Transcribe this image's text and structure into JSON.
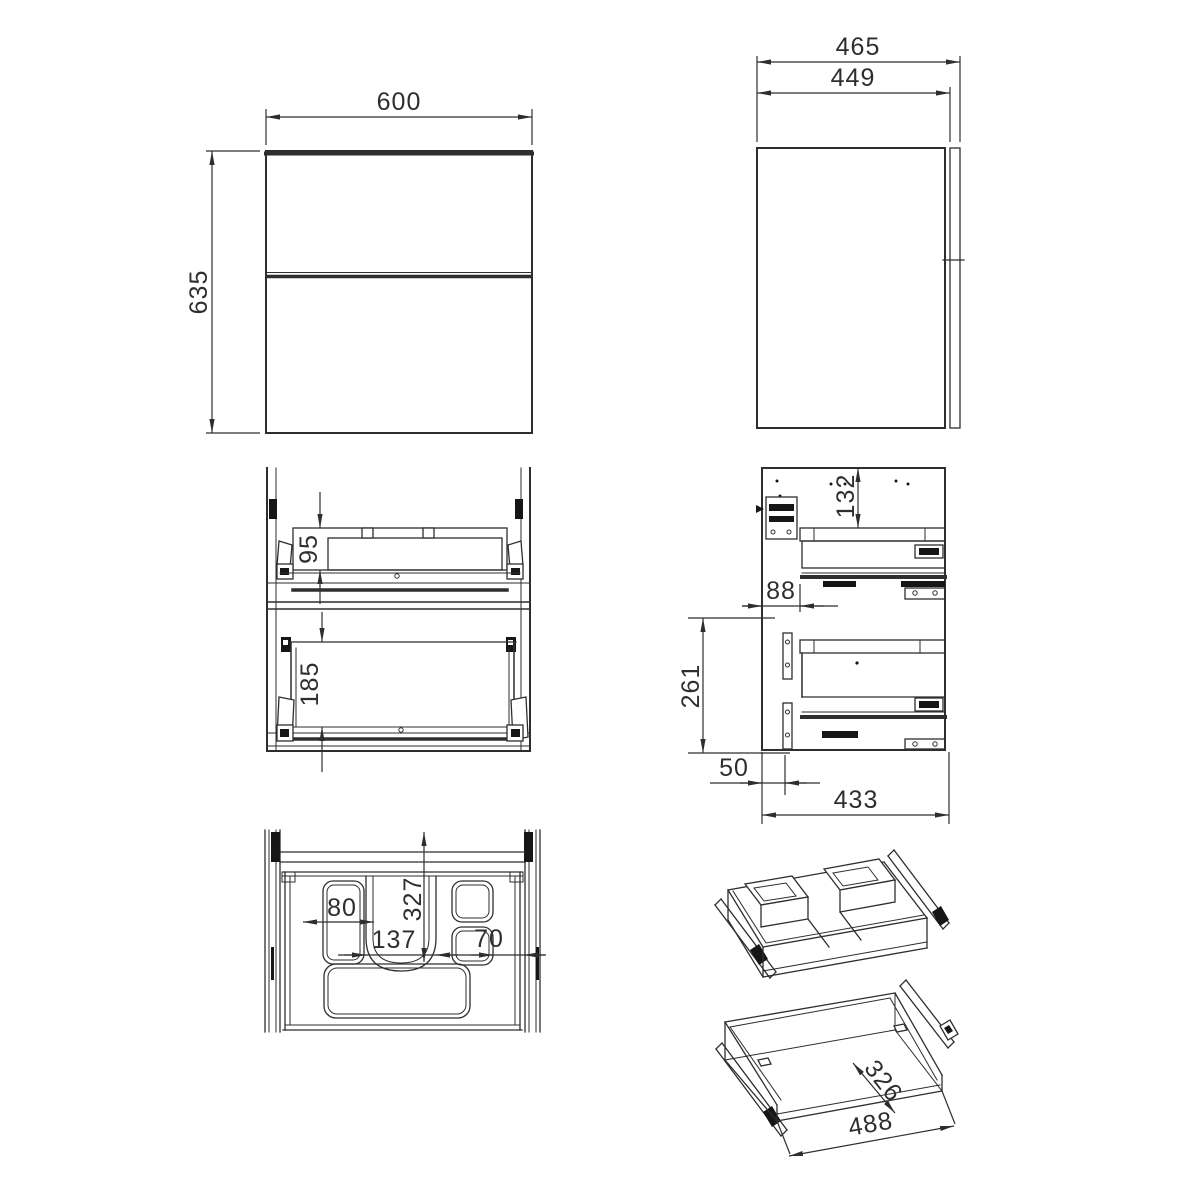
{
  "drawing": {
    "type": "furniture technical drawing - vanity cabinet with two drawers",
    "views": {
      "front": {
        "width": "600",
        "height": "635"
      },
      "side": {
        "depth_total": "465",
        "depth_carcass": "449"
      },
      "front_section": {
        "top_drawer_height": "95",
        "bottom_drawer_height": "185"
      },
      "side_section": {
        "top_clearance": "132",
        "front_offset": "88",
        "rail_pitch": "261",
        "bottom_offset": "50",
        "internal_depth": "433"
      },
      "plan": {
        "left_tray_width": "80",
        "center_cutout_width": "137",
        "tray_depth": "327",
        "right_tray_width": "70"
      },
      "iso_drawer": {
        "depth": "326",
        "width": "488"
      }
    },
    "colors": {
      "line": "#2e2e2e",
      "background": "#ffffff",
      "hardware": "#161616"
    }
  }
}
